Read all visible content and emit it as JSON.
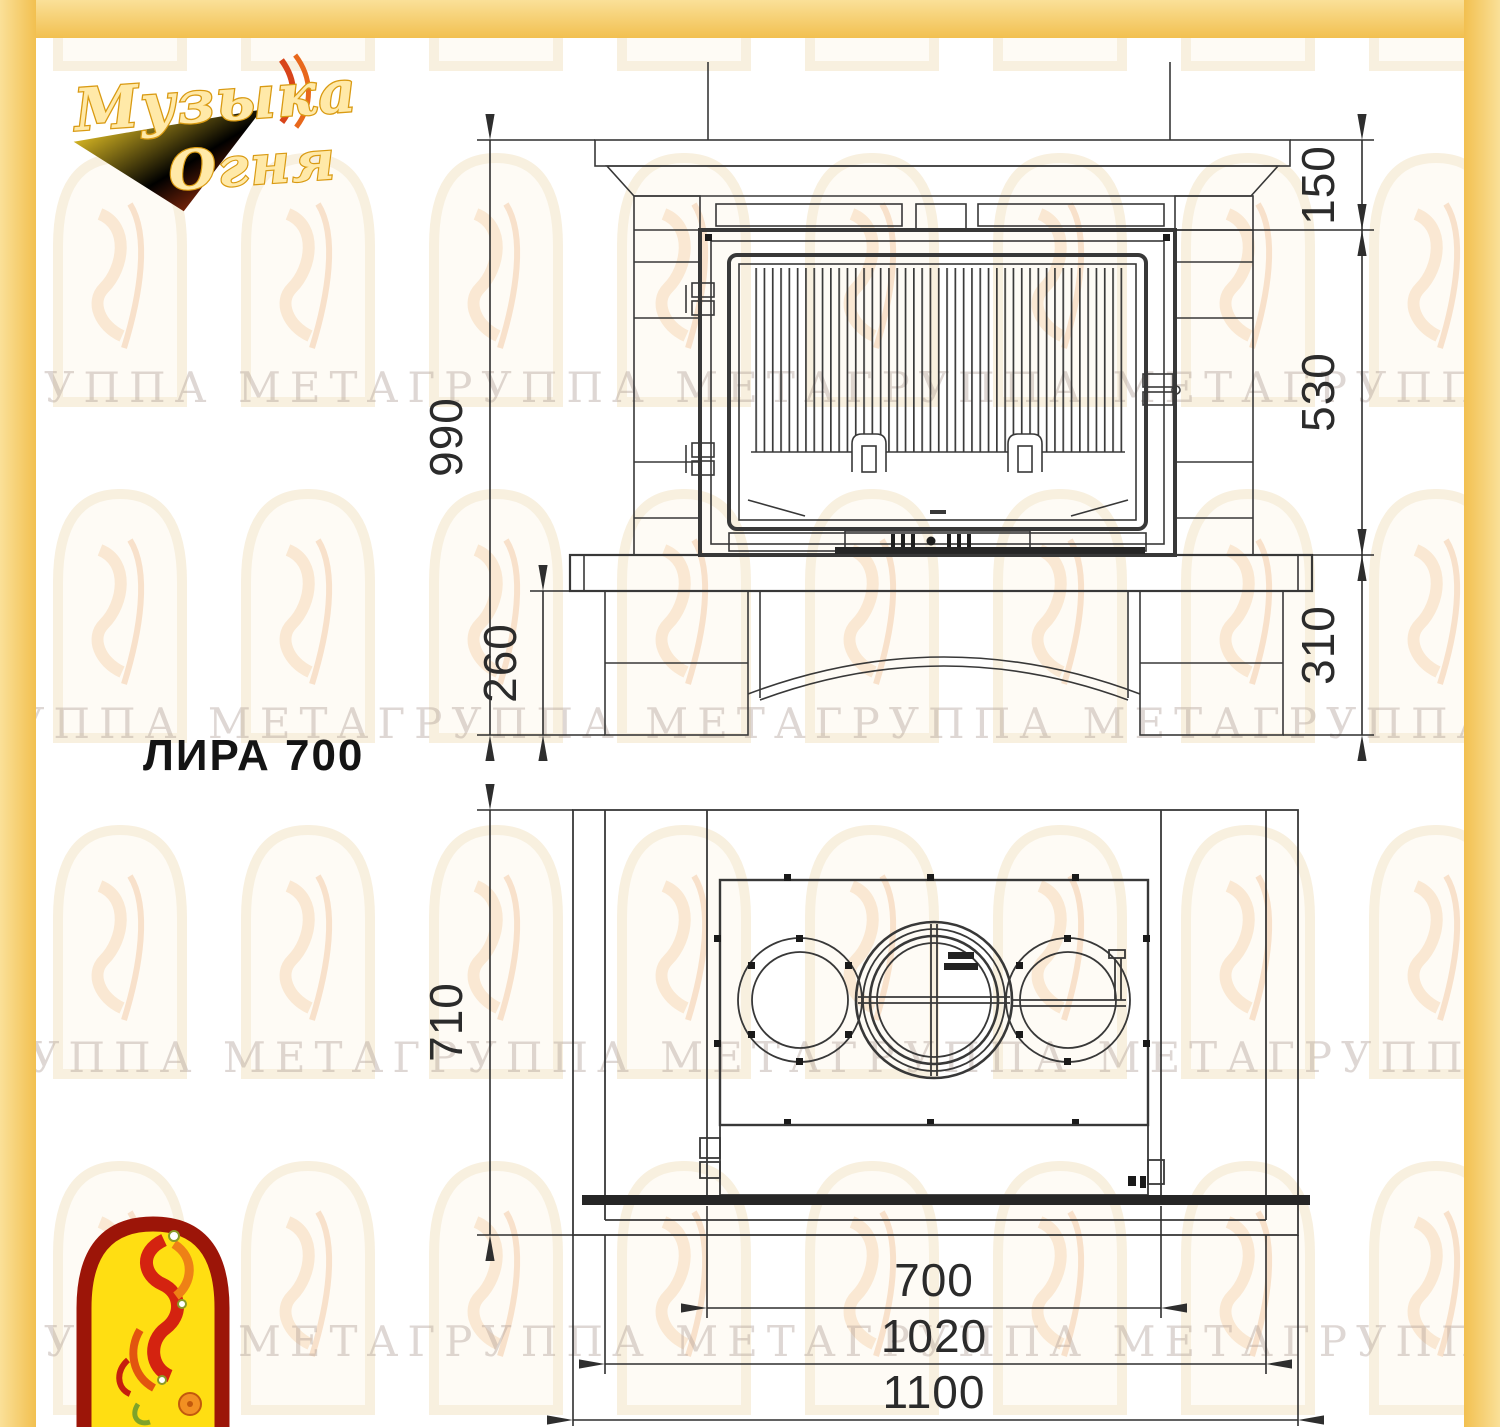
{
  "title": "ЛИРА 700",
  "brand_logo": {
    "line1": "Музыка",
    "line2": "Огня"
  },
  "watermark_text": "ГРУППА МЕТАГРУППА МЕТАГРУППА МЕТАГРУППА МЕТАГРУППА МЕТА",
  "front_view": {
    "dims": {
      "total_height": "990",
      "mantel_to_insert": "150",
      "insert_height": "530",
      "hearth_to_floor": "310",
      "base_height": "260"
    }
  },
  "plan_view": {
    "dims": {
      "depth": "710",
      "insert_width": "700",
      "inner_width": "1020",
      "total_width": "1100"
    }
  },
  "colors": {
    "border_outer": "#fae098",
    "border_inner": "#f2c050",
    "line": "#383838",
    "bold_line": "#262626",
    "watermark": "#b3a29a",
    "logo_gold": "#efa615",
    "logo_red": "#d42310",
    "logo_arch_fill": "#ffde12",
    "logo_arch_border": "#9c1508"
  }
}
